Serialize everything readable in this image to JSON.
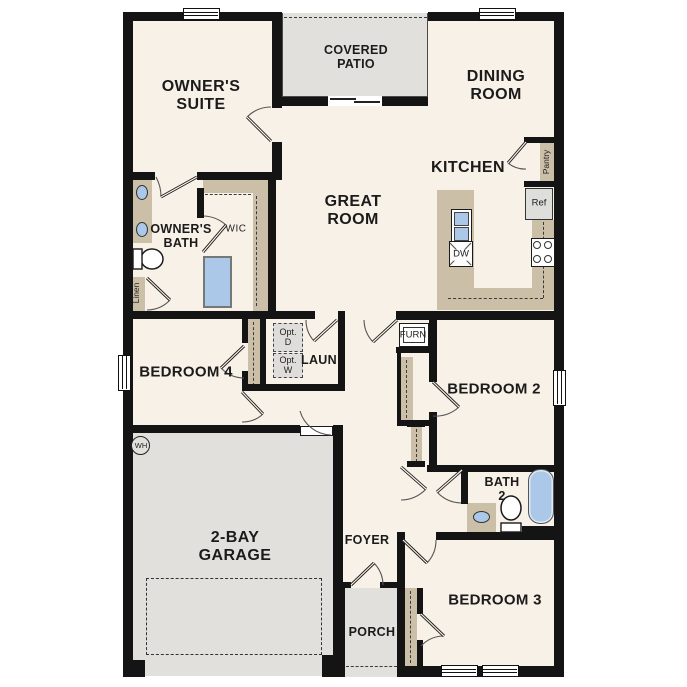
{
  "colors": {
    "floor": "#f8f1e7",
    "hard": "#e1e0dd",
    "cabinet": "#cbbfa7",
    "wall": "#141414",
    "fixture": "#abc8e9"
  },
  "rooms": {
    "owners_suite": {
      "lines": [
        "OWNER'S",
        "SUITE"
      ]
    },
    "covered_patio": {
      "lines": [
        "COVERED",
        "PATIO"
      ]
    },
    "dining_room": {
      "lines": [
        "DINING",
        "ROOM"
      ]
    },
    "great_room": {
      "lines": [
        "GREAT",
        "ROOM"
      ]
    },
    "kitchen": {
      "lines": [
        "KITCHEN"
      ]
    },
    "owners_bath": {
      "lines": [
        "OWNER'S",
        "BATH"
      ]
    },
    "wic": {
      "lines": [
        "WIC"
      ]
    },
    "laundry": {
      "lines": [
        "LAUN"
      ]
    },
    "bedroom4": {
      "lines": [
        "BEDROOM 4"
      ]
    },
    "bedroom2": {
      "lines": [
        "BEDROOM 2"
      ]
    },
    "bedroom3": {
      "lines": [
        "BEDROOM 3"
      ]
    },
    "bath2": {
      "lines": [
        "BATH",
        "2"
      ]
    },
    "garage": {
      "lines": [
        "2-BAY",
        "GARAGE"
      ]
    },
    "foyer": {
      "lines": [
        "FOYER"
      ]
    },
    "porch": {
      "lines": [
        "PORCH"
      ]
    }
  },
  "fixtures": {
    "pantry": {
      "lines": [
        "Pantry"
      ]
    },
    "linen": {
      "lines": [
        "Linen"
      ]
    },
    "ref": {
      "lines": [
        "Ref"
      ]
    },
    "dw": {
      "lines": [
        "DW"
      ]
    },
    "furn": {
      "lines": [
        "FURN"
      ]
    },
    "wh": {
      "lines": [
        "WH"
      ]
    },
    "opt_d": {
      "lines": [
        "Opt.",
        "D"
      ]
    },
    "opt_w": {
      "lines": [
        "Opt.",
        "W"
      ]
    }
  }
}
